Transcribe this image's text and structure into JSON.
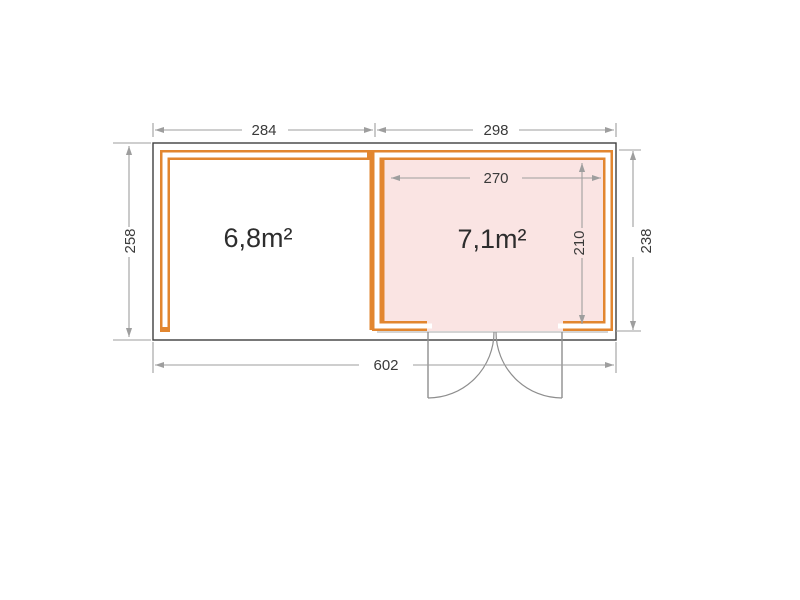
{
  "plan": {
    "rooms": {
      "left": {
        "area_label": "6,8m²"
      },
      "right": {
        "area_label": "7,1m²"
      }
    },
    "dimensions": {
      "top_left_width": "284",
      "top_right_width": "298",
      "left_height": "258",
      "right_height": "238",
      "inner_width": "270",
      "inner_height": "210",
      "total_width": "602"
    },
    "colors": {
      "wall": "#E2862F",
      "room_fill": "#FAE4E3",
      "outline": "#3F3F3F",
      "dimension": "#9E9E9E",
      "dimension_text": "#3A3A3A",
      "room_text": "#2D2D2D",
      "door": "#8E8E8E"
    }
  }
}
